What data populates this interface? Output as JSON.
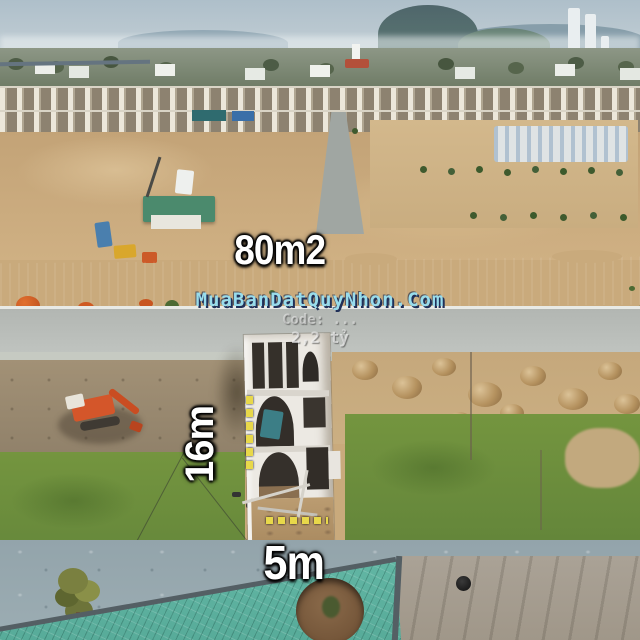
{
  "overlays": {
    "area_label": "80m2",
    "depth_label": "16m",
    "width_label": "5m"
  },
  "watermark": {
    "line1": "MuaBanDatQuyNhon.Com",
    "line2": "Code: ...",
    "line3": "2,2 tỷ"
  },
  "colors": {
    "label_text": "#ffffff",
    "label_outline": "#000000",
    "dash_yellow": "#e8d84a",
    "watermark_cyan": "#98dcec",
    "roof_teal": "#5fb3a1",
    "grass": "#6f923f",
    "sand": "#c9a878",
    "sky": "#b9c8d1"
  }
}
